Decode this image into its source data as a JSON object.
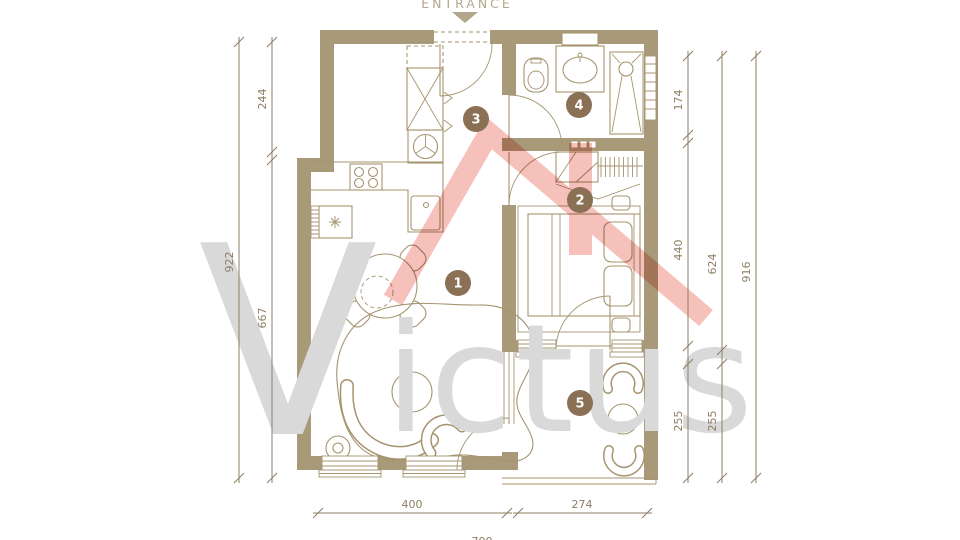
{
  "entrance": {
    "label": "ENTRANCE"
  },
  "watermark": {
    "initial": "V",
    "rest": "ictus"
  },
  "rooms": [
    {
      "number": "1"
    },
    {
      "number": "2"
    },
    {
      "number": "3"
    },
    {
      "number": "4"
    },
    {
      "number": "5"
    }
  ],
  "dimensions": {
    "left_outer": "922",
    "left_inner_top": "244",
    "left_inner_bottom": "667",
    "right_inner_top": "174",
    "right_inner_mid": "440",
    "right_inner_bottom": "255",
    "right_mid_top": "624",
    "right_mid_bottom": "255",
    "right_outer": "916",
    "bottom_left": "400",
    "bottom_right": "274",
    "bottom_total": "700"
  },
  "theme": {
    "wall_color": "#a89a78",
    "line_color": "#a5946f",
    "dim_color": "#8d7e62",
    "room_badge_color": "#8a7156",
    "watermark_gray": "#d9d9d9",
    "watermark_pink": "#f0958d",
    "entrance_color": "#b3a78b",
    "background": "#ffffff"
  }
}
